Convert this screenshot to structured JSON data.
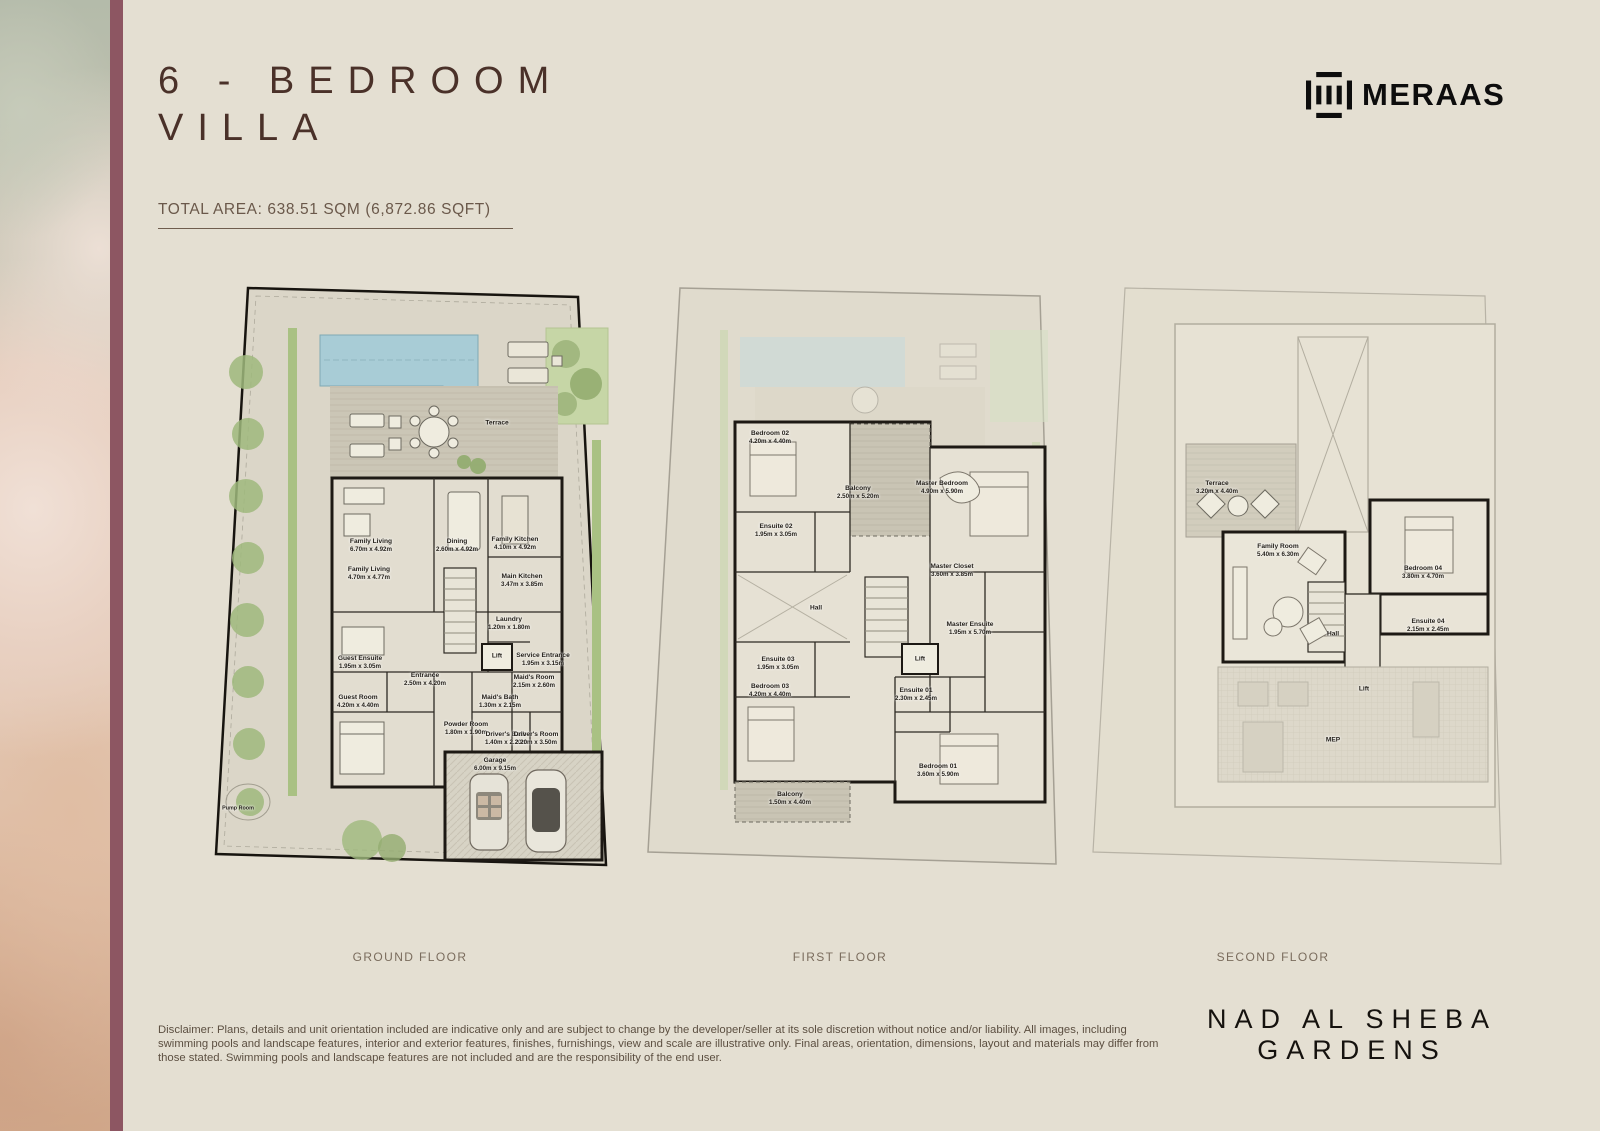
{
  "header": {
    "title_line1": "6 - BEDROOM",
    "title_line2": "VILLA",
    "total_area_label": "TOTAL AREA: 638.51 SQM (6,872.86 SQFT)",
    "brand_name": "MERAAS"
  },
  "floors": [
    {
      "id": "gf",
      "caption": "GROUND FLOOR",
      "rooms": [
        {
          "id": "terrace",
          "label": "Terrace",
          "dims": ""
        },
        {
          "id": "family-living-1",
          "label": "Family Living",
          "dims": "6.70m x 4.92m"
        },
        {
          "id": "family-living-2",
          "label": "Family Living",
          "dims": "4.70m x 4.77m"
        },
        {
          "id": "dining",
          "label": "Dining",
          "dims": "2.60m x 4.92m"
        },
        {
          "id": "family-kitchen",
          "label": "Family Kitchen",
          "dims": "4.10m x 4.92m"
        },
        {
          "id": "main-kitchen",
          "label": "Main Kitchen",
          "dims": "3.47m x 3.85m"
        },
        {
          "id": "laundry",
          "label": "Laundry",
          "dims": "1.20m x 1.80m"
        },
        {
          "id": "lift",
          "label": "Lift",
          "dims": ""
        },
        {
          "id": "service-entrance",
          "label": "Service Entrance",
          "dims": "1.95m x 3.15m"
        },
        {
          "id": "guest-ensuite",
          "label": "Guest Ensuite",
          "dims": "1.95m x 3.05m"
        },
        {
          "id": "entrance",
          "label": "Entrance",
          "dims": "2.50m x 4.20m"
        },
        {
          "id": "guest-room",
          "label": "Guest Room",
          "dims": "4.20m x 4.40m"
        },
        {
          "id": "maids-room",
          "label": "Maid's Room",
          "dims": "2.15m x 2.60m"
        },
        {
          "id": "maids-bath",
          "label": "Maid's Bath",
          "dims": "1.30m x 2.15m"
        },
        {
          "id": "powder-room",
          "label": "Powder Room",
          "dims": "1.80m x 1.90m"
        },
        {
          "id": "drivers-bath",
          "label": "Driver's Bath",
          "dims": "1.40m x 2.20m"
        },
        {
          "id": "drivers-room",
          "label": "Driver's Room",
          "dims": "2.20m x 3.50m"
        },
        {
          "id": "garage",
          "label": "Garage",
          "dims": "6.00m x 9.15m"
        },
        {
          "id": "pump-room",
          "label": "Pump Room",
          "dims": ""
        }
      ]
    },
    {
      "id": "ff",
      "caption": "FIRST FLOOR",
      "rooms": [
        {
          "id": "bedroom-02",
          "label": "Bedroom 02",
          "dims": "4.20m x 4.40m"
        },
        {
          "id": "balcony-1",
          "label": "Balcony",
          "dims": "2.50m x 5.20m"
        },
        {
          "id": "master-bedroom",
          "label": "Master Bedroom",
          "dims": "4.90m x 5.90m"
        },
        {
          "id": "ensuite-02",
          "label": "Ensuite 02",
          "dims": "1.95m x 3.05m"
        },
        {
          "id": "hall",
          "label": "Hall",
          "dims": ""
        },
        {
          "id": "master-closet",
          "label": "Master Closet",
          "dims": "3.60m x 3.85m"
        },
        {
          "id": "master-ensuite",
          "label": "Master Ensuite",
          "dims": "1.95m x 5.70m"
        },
        {
          "id": "lift",
          "label": "Lift",
          "dims": ""
        },
        {
          "id": "ensuite-03",
          "label": "Ensuite 03",
          "dims": "1.95m x 3.05m"
        },
        {
          "id": "bedroom-03",
          "label": "Bedroom 03",
          "dims": "4.20m x 4.40m"
        },
        {
          "id": "ensuite-01",
          "label": "Ensuite 01",
          "dims": "2.30m x 2.45m"
        },
        {
          "id": "bedroom-01",
          "label": "Bedroom 01",
          "dims": "3.60m x 5.90m"
        },
        {
          "id": "balcony-2",
          "label": "Balcony",
          "dims": "1.50m x 4.40m"
        }
      ]
    },
    {
      "id": "sf",
      "caption": "SECOND FLOOR",
      "rooms": [
        {
          "id": "terrace",
          "label": "Terrace",
          "dims": "3.20m x 4.40m"
        },
        {
          "id": "family-room",
          "label": "Family Room",
          "dims": "5.40m x 6.30m"
        },
        {
          "id": "bedroom-04",
          "label": "Bedroom 04",
          "dims": "3.80m x 4.70m"
        },
        {
          "id": "ensuite-04",
          "label": "Ensuite 04",
          "dims": "2.15m x 2.45m"
        },
        {
          "id": "hall",
          "label": "Hall",
          "dims": ""
        },
        {
          "id": "lift",
          "label": "Lift",
          "dims": ""
        },
        {
          "id": "mep",
          "label": "MEP",
          "dims": ""
        }
      ]
    }
  ],
  "footer": {
    "disclaimer": "Disclaimer: Plans, details and unit orientation included are indicative only and are subject to change by the developer/seller at its sole discretion without notice and/or liability. All images, including swimming pools and landscape features, interior and exterior features, finishes, furnishings, view and scale are illustrative only. Final areas, orientation, dimensions, layout and materials may differ from those stated. Swimming pools and landscape features are not included and are the responsibility of the end user.",
    "project_name_line1": "NAD AL SHEBA",
    "project_name_line2": "GARDENS"
  },
  "colors": {
    "background": "#e4dfd2",
    "accent_maroon": "#8d5662",
    "title_brown": "#4a3129",
    "pool_blue": "#a8ccd6",
    "landscape_green": "#a9c183",
    "wall_dark": "#1d1914",
    "caption_gray": "#7a6c5d"
  }
}
